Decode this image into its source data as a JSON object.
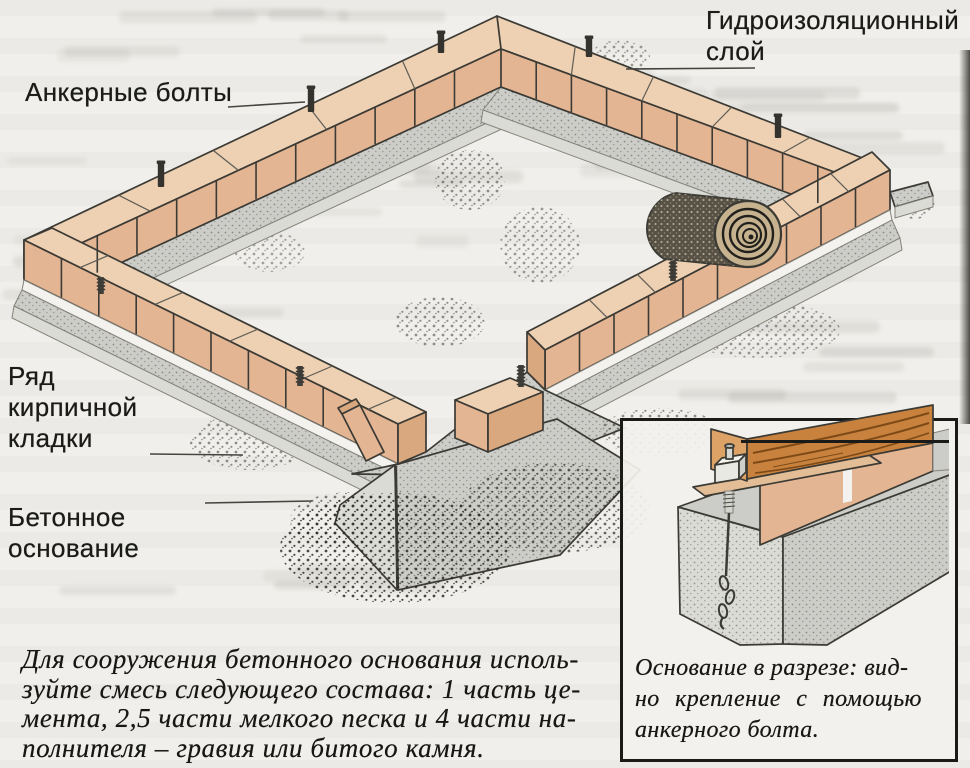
{
  "labels": {
    "waterproofing_layer": {
      "lines": [
        "Гидроизоляционный",
        "слой"
      ]
    },
    "anchor_bolts": {
      "text": "Анкерные болты"
    },
    "brick_row": {
      "lines": [
        "Ряд",
        "кирпичной",
        "кладки"
      ]
    },
    "concrete_base": {
      "lines": [
        "Бетонное",
        "основание"
      ]
    }
  },
  "body_text": {
    "lines": [
      "Для сооружения бетонного основания исполь-",
      "зуйте смесь следующего состава: 1 часть це-",
      "мента, 2,5 части мелкого песка и 4 части на-",
      "полнителя – гравия или битого камня."
    ]
  },
  "inset": {
    "caption_lines": [
      "Основание в разрезе: вид-",
      "но крепление с помощью",
      "анкерного болта."
    ]
  },
  "illustration": {
    "subjects": [
      "brick-foundation-ring",
      "anchor-bolts",
      "concrete-strip-footing",
      "waterproofing-roll",
      "loose-bricks",
      "foundation-cross-section-detail"
    ],
    "colors": {
      "brick-face": "#e3b593",
      "brick-top": "#eed0b2",
      "brick-end": "#d9a87f",
      "concrete": "#cccdc8",
      "concrete-light": "#dbdbd6",
      "outline": "#3b3a35",
      "wood": "#c8823e",
      "wood-grain": "#7d4a17",
      "roll-dark": "#575146",
      "paper": "#f0efeb"
    }
  }
}
